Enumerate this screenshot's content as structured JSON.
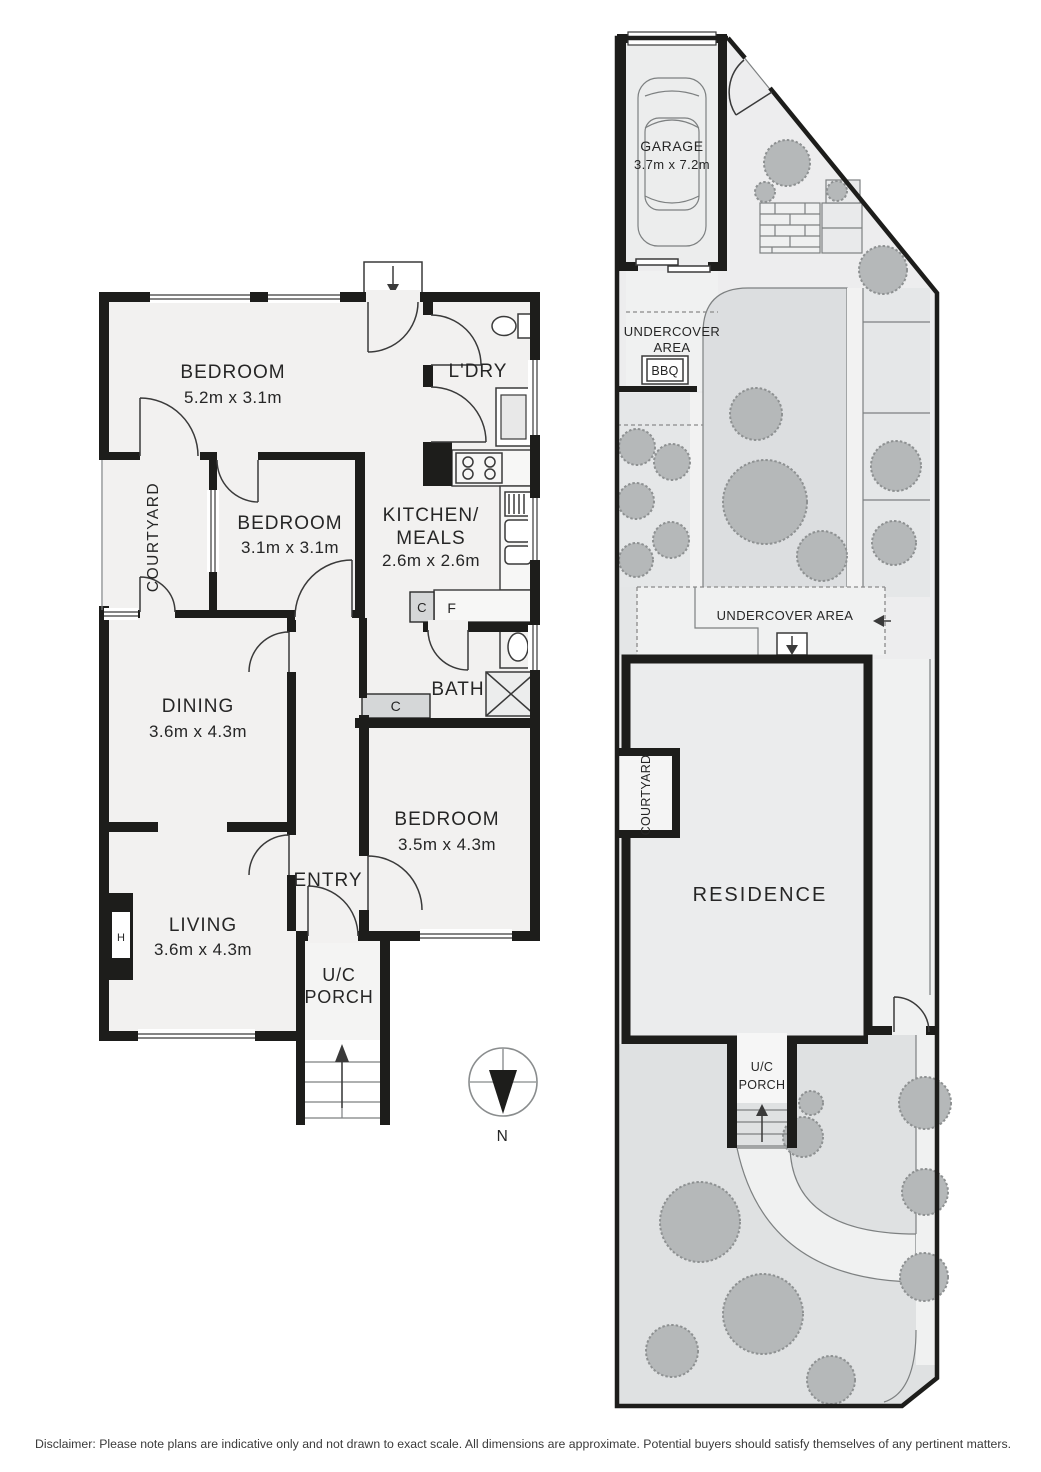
{
  "floor_plan": {
    "bedroom1": {
      "label": "BEDROOM",
      "dims": "5.2m x 3.1m"
    },
    "laundry": {
      "label": "L'DRY"
    },
    "courtyard": {
      "label": "COURTYARD"
    },
    "bedroom2": {
      "label": "BEDROOM",
      "dims": "3.1m x 3.1m"
    },
    "kitchen": {
      "label1": "KITCHEN/",
      "label2": "MEALS",
      "dims": "2.6m x 2.6m"
    },
    "dining": {
      "label": "DINING",
      "dims": "3.6m x 4.3m"
    },
    "bath": {
      "label": "BATH"
    },
    "bedroom3": {
      "label": "BEDROOM",
      "dims": "3.5m x 4.3m"
    },
    "entry": {
      "label": "ENTRY"
    },
    "living": {
      "label": "LIVING",
      "dims": "3.6m x 4.3m"
    },
    "uc_porch": {
      "label1": "U/C",
      "label2": "PORCH"
    },
    "cupboard_kitchen": "C",
    "fridge": "F",
    "cupboard_hall": "C",
    "heater": "H"
  },
  "site_plan": {
    "garage": {
      "label": "GARAGE",
      "dims": "3.7m x 7.2m"
    },
    "undercover_top": {
      "label1": "UNDERCOVER",
      "label2": "AREA"
    },
    "bbq": "BBQ",
    "undercover_mid": "UNDERCOVER AREA",
    "courtyard": "COURTYARD",
    "residence": "RESIDENCE",
    "uc_porch": {
      "label1": "U/C",
      "label2": "PORCH"
    }
  },
  "compass": {
    "north": "N"
  },
  "footer": {
    "disclaimer": "Disclaimer: Please note plans are indicative only and not drawn to exact scale. All dimensions are approximate. Potential buyers should satisfy themselves of any pertinent matters."
  },
  "colors": {
    "wall": "#1d1d1b",
    "room_fill": "#f2f1f0",
    "site_fill": "#ededee",
    "lawn": "#dcdee0",
    "garden_bed": "#e5e7e8",
    "path": "#f0f1f1",
    "tree": "#b5b8b9",
    "tree_edge": "#8e9192",
    "cupboard": "#d5d7d8",
    "text": "#262626"
  }
}
